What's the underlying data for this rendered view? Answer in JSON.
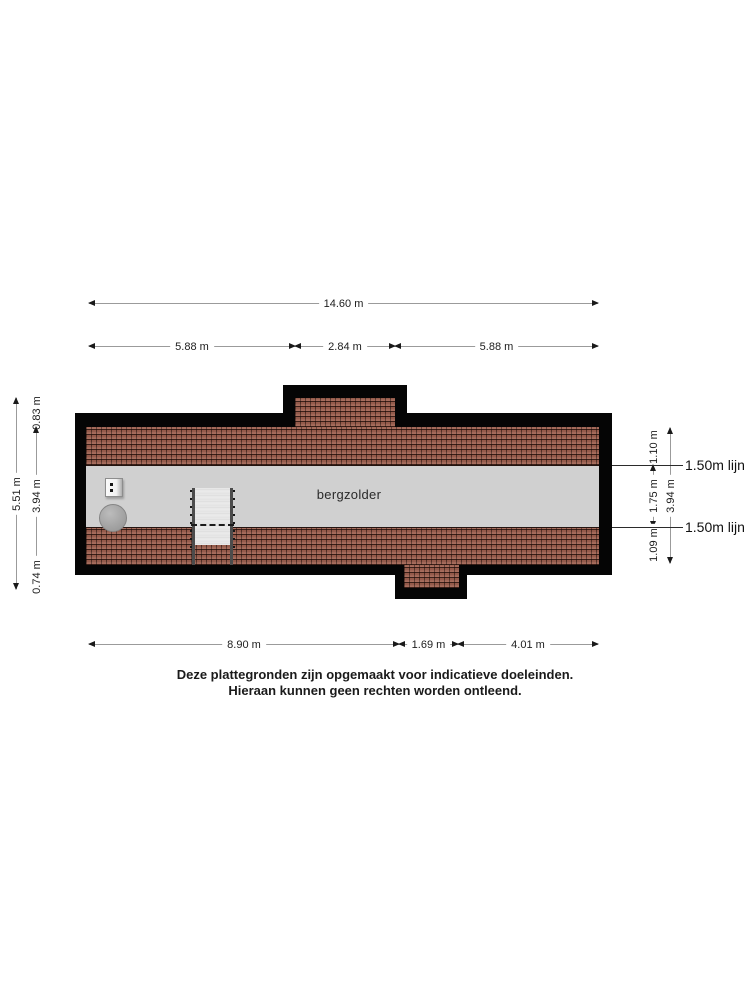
{
  "plan": {
    "room_label": "bergzolder",
    "symbols": {
      "staircase": "staircase-icon",
      "boiler": "boiler-icon",
      "electrical_box": "electrical-box-icon"
    },
    "colors": {
      "wall": "#050505",
      "roof_tiles": "#9d5f4e",
      "floor": "#d0d0d0"
    }
  },
  "dimensions": {
    "top_total": "14.60 m",
    "top_segments": [
      "5.88 m",
      "2.84 m",
      "5.88 m"
    ],
    "bottom_segments": [
      "8.90 m",
      "1.69 m",
      "4.01 m"
    ],
    "left_total": "5.51 m",
    "left_segments": [
      "0.83 m",
      "3.94 m",
      "0.74 m"
    ],
    "right_segments": [
      "1.10 m",
      "1.75 m",
      "1.09 m"
    ],
    "right_total": "3.94 m",
    "headroom_line_top": "1.50m lijn",
    "headroom_line_bottom": "1.50m lijn"
  },
  "disclaimer": {
    "line1": "Deze plattegronden zijn opgemaakt voor indicatieve doeleinden.",
    "line2": "Hieraan kunnen geen rechten worden ontleend."
  }
}
